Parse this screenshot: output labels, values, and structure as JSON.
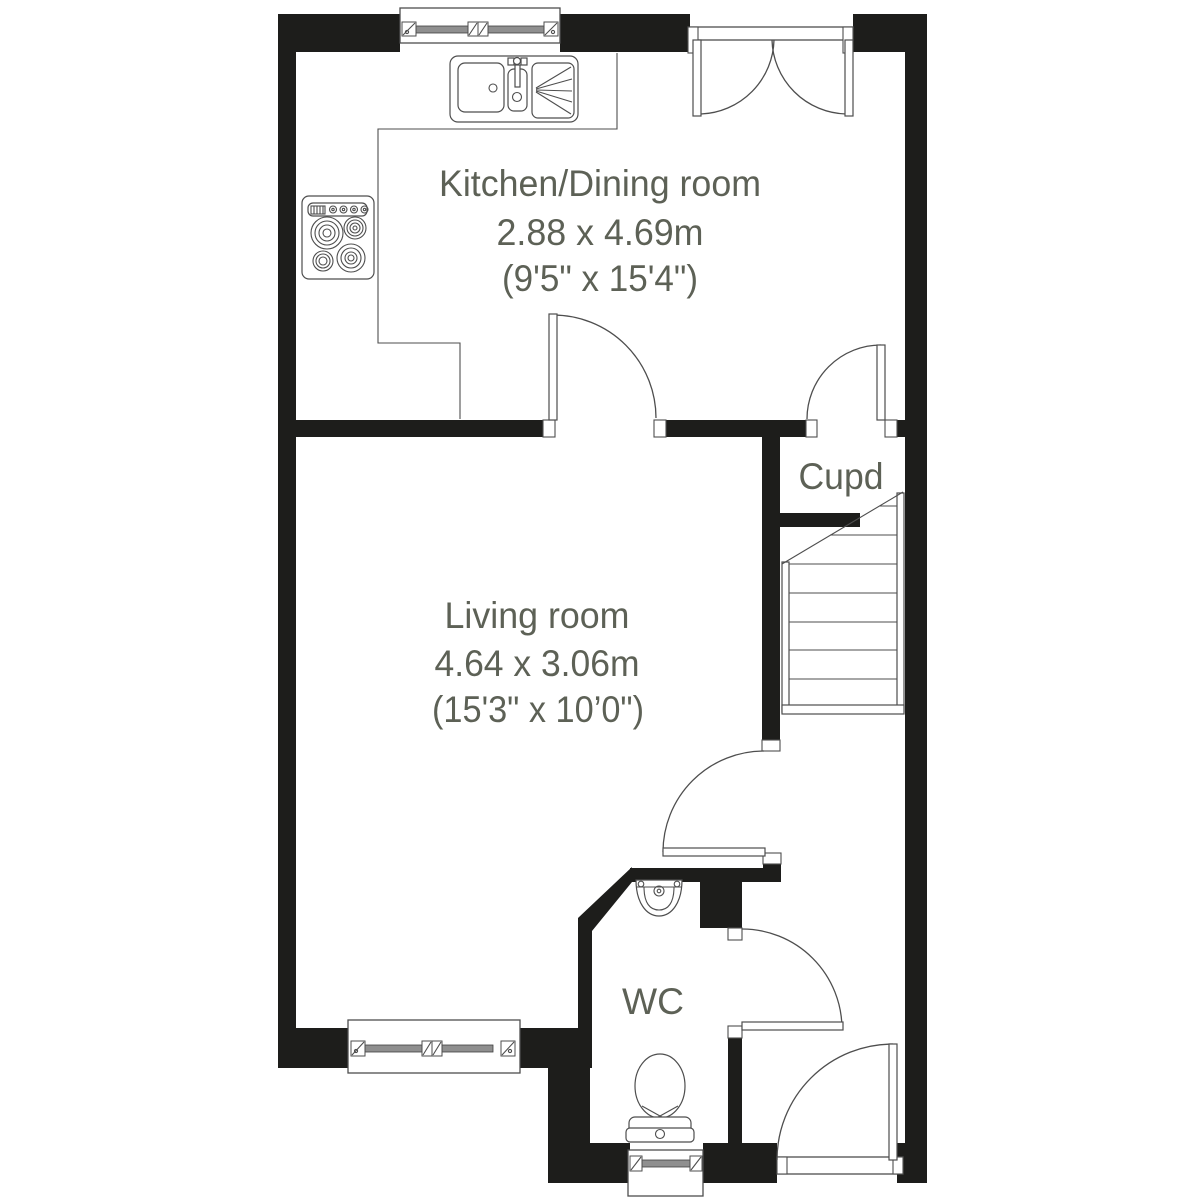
{
  "rooms": [
    {
      "name": "Kitchen/Dining room",
      "size_metric": "2.88 x 4.69m",
      "size_imperial": "(9'5\" x 15'4\")"
    },
    {
      "name": "Living room",
      "size_metric": "4.64 x 3.06m",
      "size_imperial": "(15'3\" x 10’0\")"
    },
    {
      "name": "Cupd"
    },
    {
      "name": "WC"
    }
  ],
  "colors": {
    "wall": "#1d1d1b",
    "fixture_line": "#4e4e4e",
    "label_text": "#5d6156",
    "background": "#ffffff"
  }
}
